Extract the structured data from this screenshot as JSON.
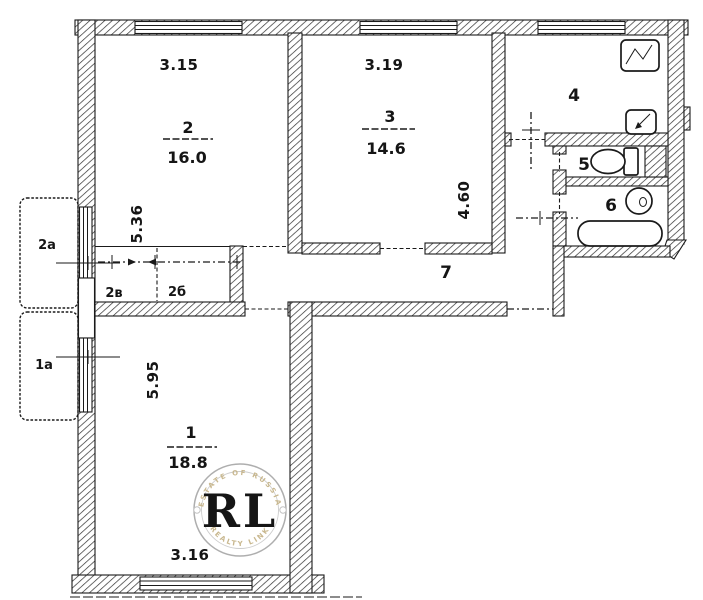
{
  "labels": {
    "room1": {
      "number": "1",
      "area": "18.8",
      "width": "3.16",
      "depth": "5.95"
    },
    "room2": {
      "number": "2",
      "area": "16.0",
      "width": "3.15",
      "depth": "5.36"
    },
    "room3": {
      "number": "3",
      "area": "14.6",
      "width": "3.19",
      "depth": "4.60"
    },
    "room4": {
      "number": "4"
    },
    "room5": {
      "number": "5"
    },
    "room6": {
      "number": "6"
    },
    "room7": {
      "number": "7"
    },
    "balcony_top": "2а",
    "balcony_bottom": "1а",
    "closet_left": "2в",
    "closet_right": "2б"
  },
  "fixtures": {
    "stove": "stove-icon",
    "kitchen_vent": "vent-box-icon",
    "toilet": "toilet-icon",
    "washbasin": "washbasin-icon",
    "bathtub": "bathtub-icon"
  },
  "watermark": {
    "initials": "RL",
    "arc_top": "ESTATE OF RUSSIA",
    "arc_bottom": "REALTY LINK"
  },
  "colors": {
    "ink": "#1a1a1a",
    "paper": "#ffffff",
    "watermark_gold": "#c59a35",
    "watermark_ring": "#aeaeae"
  }
}
